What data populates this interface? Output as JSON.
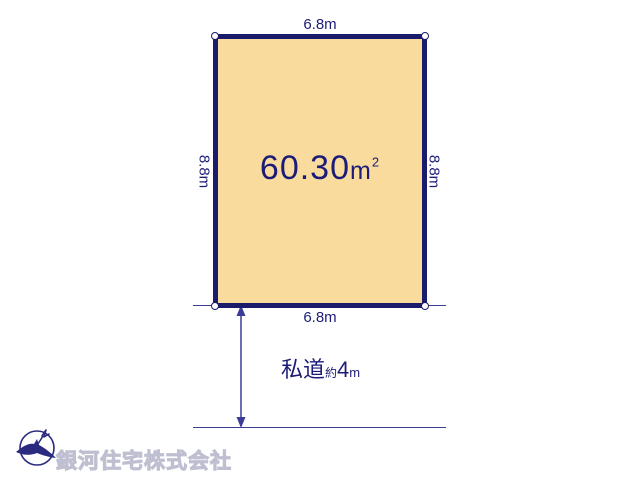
{
  "diagram": {
    "area": {
      "value": "60.30",
      "unit": "m",
      "exponent": "2"
    },
    "dimensions": {
      "top": "6.8m",
      "bottom": "6.8m",
      "left": "8.8m",
      "right": "8.8m"
    },
    "road": {
      "name": "私道",
      "approx": "約",
      "value": "4",
      "unit": "m"
    },
    "colors": {
      "plot_fill": "#f8db9d",
      "plot_border": "#1b1b6b",
      "label_text": "#1c1c78",
      "line": "#3c3c96",
      "watermark": "#c9c9db"
    }
  },
  "branding": {
    "company_name": "銀河住宅株式会社",
    "compass_icon": "north-compass-icon"
  }
}
